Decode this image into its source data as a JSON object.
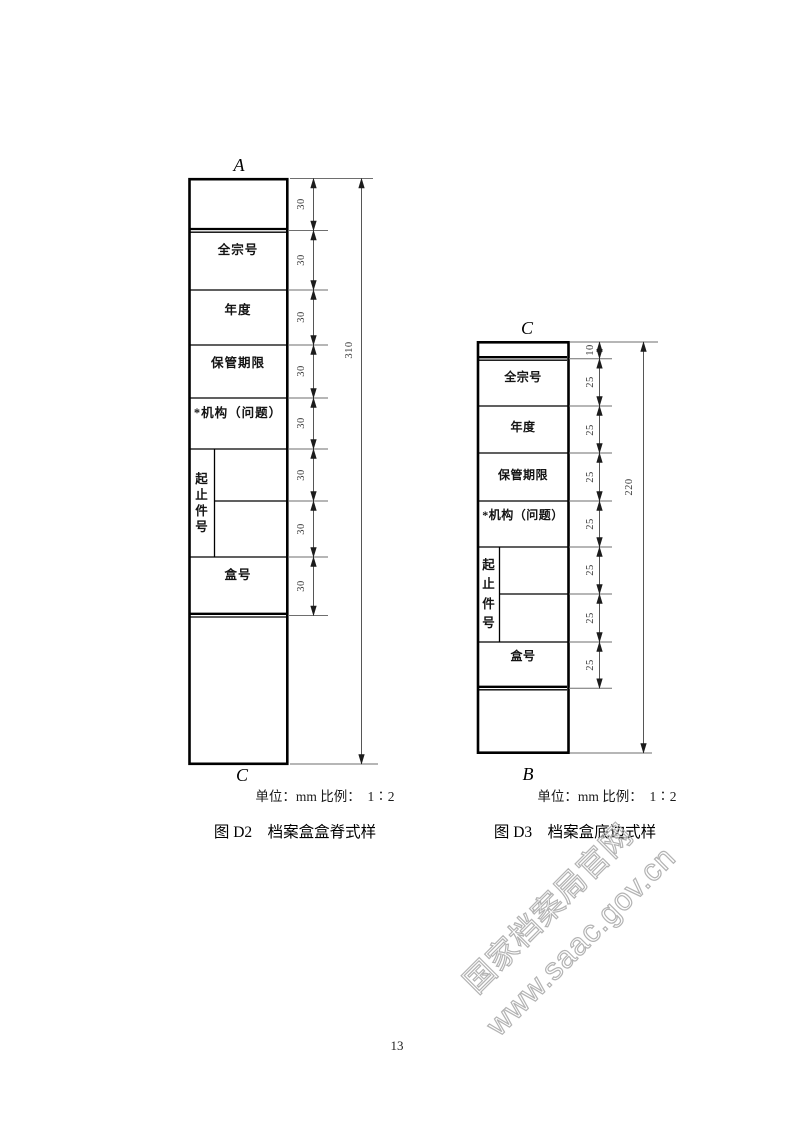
{
  "page": {
    "number": "13"
  },
  "watermark": {
    "line1": "国家档案局官网",
    "line2": "www.saac.gov.cn",
    "color": "#b3b3b3"
  },
  "figure_d2": {
    "top_label": "A",
    "bottom_label": "C",
    "cells": [
      "全宗号",
      "年度",
      "保管期限",
      "*机构（问题）",
      "盒号"
    ],
    "vertical_label_chars": [
      "起",
      "止",
      "件",
      "号"
    ],
    "segment_dims": [
      "30",
      "30",
      "30",
      "30",
      "30",
      "30",
      "30",
      "30"
    ],
    "total_dim": "310",
    "unit_scale_note": "单位：mm 比例：　1∶2",
    "caption": "图 D2　档案盒盒脊式样"
  },
  "figure_d3": {
    "top_label": "C",
    "bottom_label": "B",
    "cells": [
      "全宗号",
      "年度",
      "保管期限",
      "*机构（问题）",
      "盒号"
    ],
    "vertical_label_chars": [
      "起",
      "止",
      "件",
      "号"
    ],
    "segment_dims": [
      "10",
      "25",
      "25",
      "25",
      "25",
      "25",
      "25",
      "25"
    ],
    "total_dim": "220",
    "unit_scale_note": "单位：mm 比例：　1∶2",
    "caption": "图 D3　档案盒底边式样"
  }
}
